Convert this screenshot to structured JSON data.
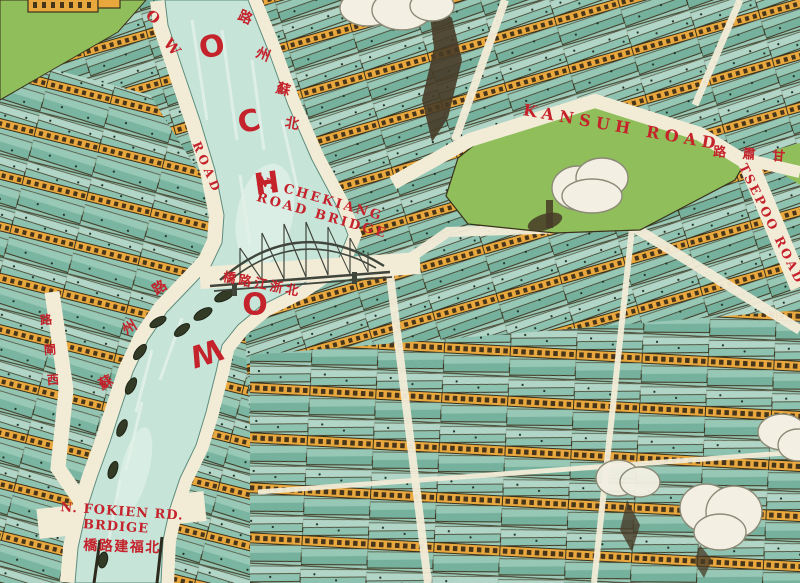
{
  "colors": {
    "label_red": "#c5232b",
    "creek": "#c7e4d9",
    "creek_streak": "#e2f1e9",
    "road": "#f2ecd7",
    "park": "#8fbe5a",
    "roof": "#8ec2b0",
    "roof_light": "#b8d9ca",
    "roof_dark": "#76b19e",
    "wall": "#e8a83e",
    "outline": "#39321c",
    "smoke_fill": "#f3f0e3",
    "smoke_line": "#8c8a77",
    "dark_smoke": "#473b27",
    "boat": "#333b26",
    "bridge": "#41463d"
  },
  "creek": {
    "name_letters": [
      "O",
      "C",
      "H",
      "O",
      "W"
    ]
  },
  "roads": {
    "west_bank_upper_letters": [
      "O",
      "W"
    ],
    "west_bank_road_word": "ROAD",
    "east_bank_zh": [
      "路",
      "州",
      "蘇",
      "北"
    ],
    "west_bank_zh": [
      "路",
      "州",
      "蘇"
    ],
    "west_inner_zh": [
      "路",
      "閘",
      "西"
    ],
    "kansuh_en": "KANSUH ROAD",
    "kansuh_zh": "路 肅 甘",
    "tsepoo_en": "TSEPOO ROAD"
  },
  "bridges": {
    "chekiang_line1": "N. CHEKIANG",
    "chekiang_line2": "ROAD BRIDGE",
    "chekiang_zh": "橋路江浙北",
    "fokien_line1": "N. FOKIEN RD.",
    "fokien_line2": "BRDIGE",
    "fokien_zh": "橋路建福北"
  }
}
